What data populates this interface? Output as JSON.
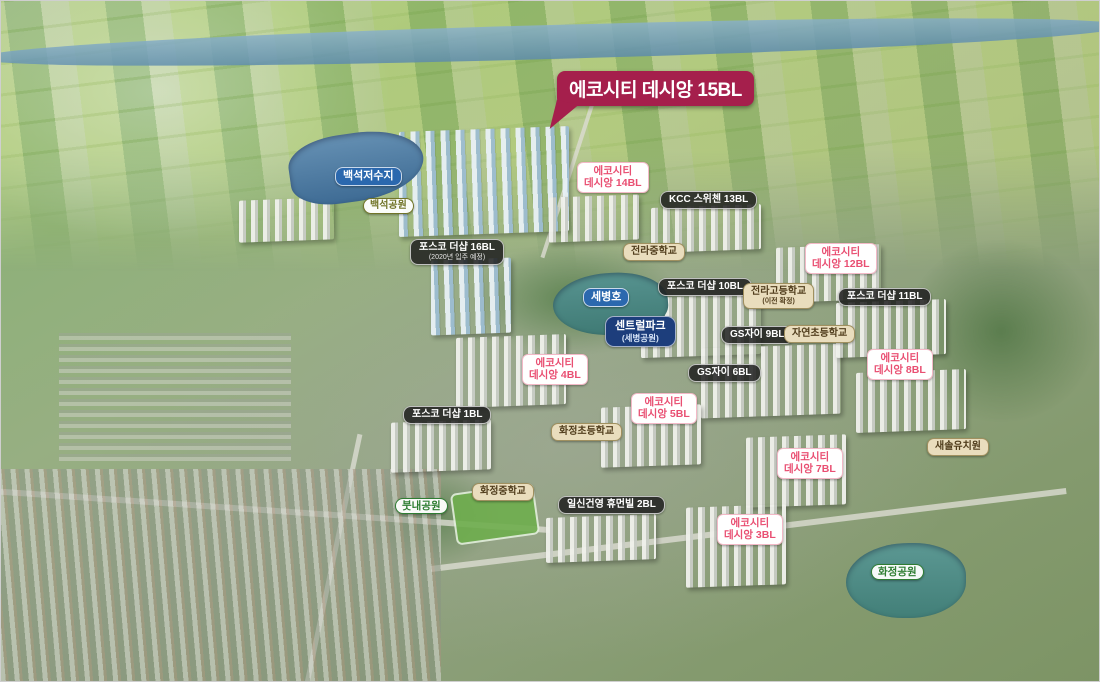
{
  "colors": {
    "callout_bg": "#a51f4c",
    "pink_label_text": "#e94f72",
    "dark_label_bg": "#1e1e1e",
    "beige_label_bg": "#e9ddbd",
    "beige_label_text": "#503d1c",
    "blue_label_bg": "#2b68ae",
    "navy_label_bg": "#1d3e7c",
    "park_label_text": "#2e7d32",
    "olive_label_text": "#717428"
  },
  "callout": {
    "label": "에코시티 데시앙 15BL"
  },
  "markers": [
    {
      "name": "baekseok-reservoir",
      "line1": "백석저수지"
    },
    {
      "name": "baekseok-park",
      "line1": "백석공원"
    },
    {
      "name": "ecocity-desian-14bl",
      "line1": "에코시티",
      "line2": "데시앙 14BL"
    },
    {
      "name": "kcc-switzen-13bl",
      "line1": "KCC 스위첸 13BL"
    },
    {
      "name": "posco-the-sharp-16bl",
      "line1": "포스코 더샵 16BL",
      "line2": "(2020년 입주 예정)"
    },
    {
      "name": "jeonra-middle-school",
      "line1": "전라중학교"
    },
    {
      "name": "sebyeong-lake",
      "line1": "세병호"
    },
    {
      "name": "posco-the-sharp-10bl",
      "line1": "포스코 더샵 10BL"
    },
    {
      "name": "ecocity-desian-12bl",
      "line1": "에코시티",
      "line2": "데시앙 12BL"
    },
    {
      "name": "jeonra-high-school",
      "line1": "전라고등학교",
      "line2": "(이전 확정)"
    },
    {
      "name": "posco-the-sharp-11bl",
      "line1": "포스코 더샵 11BL"
    },
    {
      "name": "central-park",
      "line1": "센트럴파크",
      "line2": "(세병공원)"
    },
    {
      "name": "gs-xi-9bl",
      "line1": "GS자이 9BL"
    },
    {
      "name": "jayeon-elementary-school",
      "line1": "자연초등학교"
    },
    {
      "name": "ecocity-desian-4bl",
      "line1": "에코시티",
      "line2": "데시앙 4BL"
    },
    {
      "name": "gs-xi-6bl",
      "line1": "GS자이 6BL"
    },
    {
      "name": "ecocity-desian-8bl",
      "line1": "에코시티",
      "line2": "데시앙 8BL"
    },
    {
      "name": "posco-the-sharp-1bl",
      "line1": "포스코 더샵 1BL"
    },
    {
      "name": "ecocity-desian-5bl",
      "line1": "에코시티",
      "line2": "데시앙 5BL"
    },
    {
      "name": "hwajeong-elementary-school",
      "line1": "화정초등학교"
    },
    {
      "name": "ecocity-desian-7bl",
      "line1": "에코시티",
      "line2": "데시앙 7BL"
    },
    {
      "name": "saesol-kindergarten",
      "line1": "새솔유치원"
    },
    {
      "name": "hwajeong-middle-school",
      "line1": "화정중학교"
    },
    {
      "name": "ilshin-gunyoung-humanville-2bl",
      "line1": "일신건영 휴먼빌 2BL"
    },
    {
      "name": "butnae-park",
      "line1": "붓내공원"
    },
    {
      "name": "ecocity-desian-3bl",
      "line1": "에코시티",
      "line2": "데시앙 3BL"
    },
    {
      "name": "hwajeong-park",
      "line1": "화정공원"
    }
  ]
}
